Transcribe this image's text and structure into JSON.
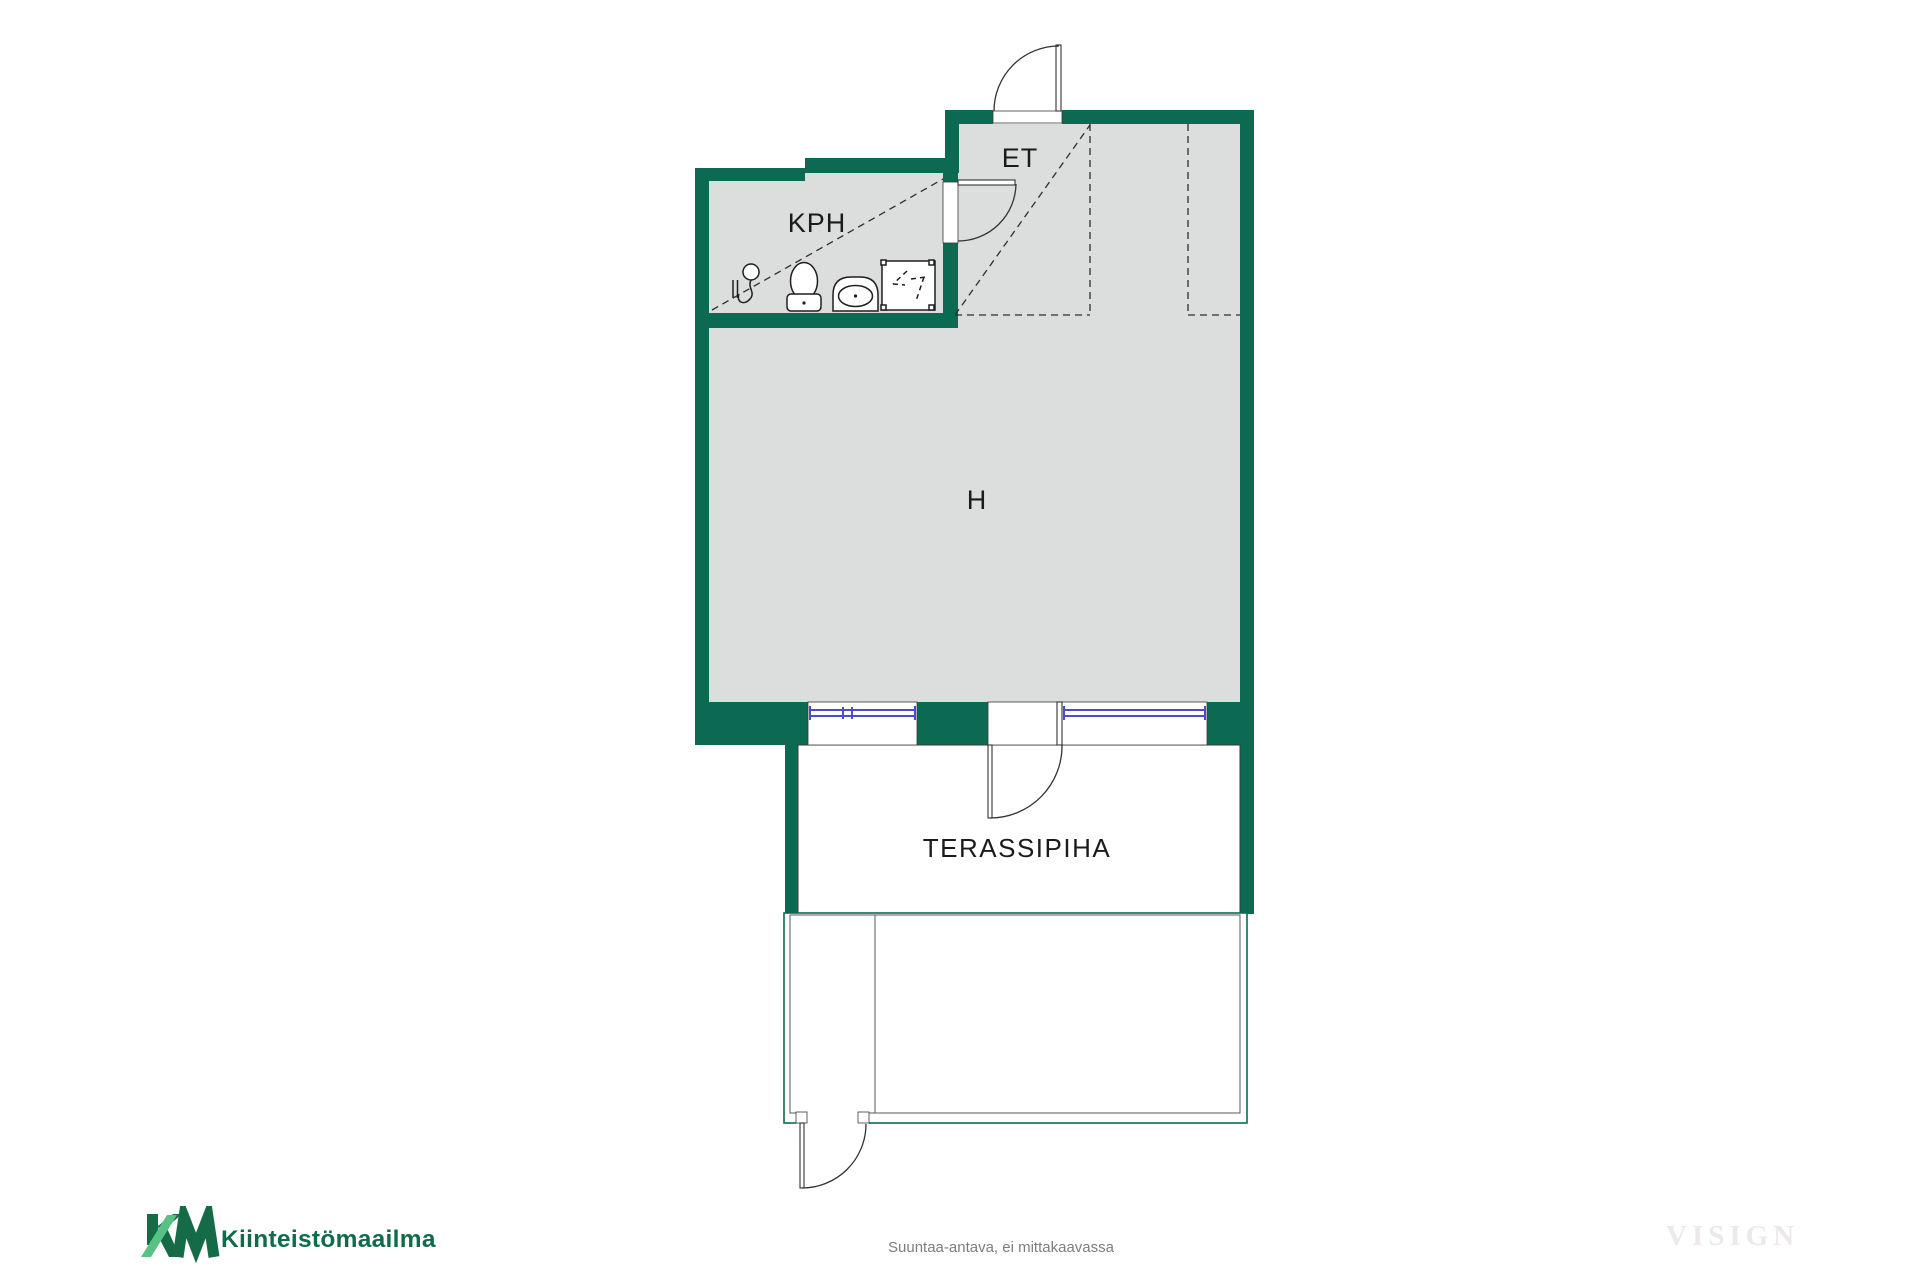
{
  "floorplan": {
    "rooms": [
      {
        "id": "kph",
        "label": "KPH"
      },
      {
        "id": "et",
        "label": "ET"
      },
      {
        "id": "h",
        "label": "H"
      },
      {
        "id": "terassipiha",
        "label": "TERASSIPIHA"
      }
    ],
    "fixtures": [
      "shower-mixer-icon",
      "toilet-icon",
      "sink-icon",
      "shower-enclosure-icon"
    ],
    "colors": {
      "wall_green": "#0d6a52",
      "floor_gray": "#dcdddd",
      "window_blue": "#4d4dc9",
      "line_dark": "#3a3a3a"
    }
  },
  "footer": {
    "logo": {
      "mark": "KM",
      "text": "Kiinteistömaailma",
      "dark_green": "#156b46",
      "light_green": "#58c283",
      "text_color": "#0f6b4a"
    },
    "disclaimer": "Suuntaa-antava, ei mittakaavassa",
    "watermark": "VISIGN"
  }
}
